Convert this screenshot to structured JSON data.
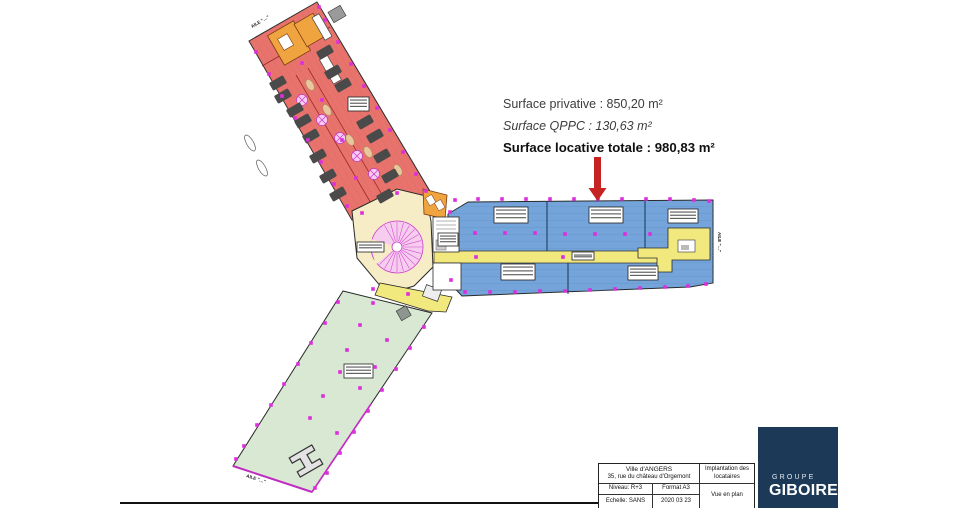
{
  "annotation": {
    "surface_privative": "Surface privative : 850,20 m²",
    "surface_qppc": "Surface QPPC : 130,63 m²",
    "surface_locative_totale": "Surface locative totale : 980,83 m²"
  },
  "plan": {
    "wing_labels": {
      "top": "AILE \"…\"",
      "right": "AILE \"…\"",
      "bottom": "AILE \"…\""
    },
    "colors": {
      "red_wing": "#E8736D",
      "blue_wing": "#74A4DA",
      "green_wing": "#D8E8D2",
      "center": "#F6ECC5",
      "corridor": "#F2E97E",
      "orange_room": "#F0A440",
      "marker": "#DD2EDD",
      "furniture": "#4A4A4A",
      "arrow": "#C62222"
    },
    "column_markers": [
      [
        455,
        200
      ],
      [
        478,
        199
      ],
      [
        502,
        199
      ],
      [
        526,
        199
      ],
      [
        550,
        199
      ],
      [
        574,
        199
      ],
      [
        598,
        199
      ],
      [
        622,
        199
      ],
      [
        646,
        199
      ],
      [
        670,
        199
      ],
      [
        694,
        200
      ],
      [
        709,
        201
      ],
      [
        475,
        233
      ],
      [
        505,
        233
      ],
      [
        535,
        233
      ],
      [
        565,
        234
      ],
      [
        595,
        234
      ],
      [
        625,
        234
      ],
      [
        650,
        234
      ],
      [
        465,
        292
      ],
      [
        490,
        292
      ],
      [
        515,
        292
      ],
      [
        540,
        291
      ],
      [
        565,
        291
      ],
      [
        590,
        290
      ],
      [
        615,
        289
      ],
      [
        640,
        288
      ],
      [
        665,
        287
      ],
      [
        688,
        286
      ],
      [
        706,
        284
      ],
      [
        476,
        257
      ],
      [
        563,
        257
      ],
      [
        450,
        212
      ],
      [
        451,
        280
      ],
      [
        319,
        7
      ],
      [
        325,
        20
      ],
      [
        338,
        42
      ],
      [
        351,
        64
      ],
      [
        364,
        86
      ],
      [
        377,
        108
      ],
      [
        390,
        130
      ],
      [
        403,
        152
      ],
      [
        416,
        174
      ],
      [
        426,
        191
      ],
      [
        256,
        52
      ],
      [
        269,
        74
      ],
      [
        282,
        96
      ],
      [
        295,
        118
      ],
      [
        308,
        140
      ],
      [
        321,
        162
      ],
      [
        334,
        184
      ],
      [
        347,
        206
      ],
      [
        302,
        63
      ],
      [
        322,
        100
      ],
      [
        342,
        140
      ],
      [
        356,
        178
      ],
      [
        338,
        302
      ],
      [
        325,
        323
      ],
      [
        311,
        343
      ],
      [
        298,
        364
      ],
      [
        284,
        384
      ],
      [
        271,
        405
      ],
      [
        257,
        425
      ],
      [
        244,
        446
      ],
      [
        236,
        459
      ],
      [
        424,
        327
      ],
      [
        410,
        348
      ],
      [
        396,
        369
      ],
      [
        382,
        390
      ],
      [
        368,
        411
      ],
      [
        354,
        432
      ],
      [
        340,
        453
      ],
      [
        327,
        473
      ],
      [
        315,
        488
      ],
      [
        373,
        303
      ],
      [
        360,
        325
      ],
      [
        387,
        340
      ],
      [
        347,
        350
      ],
      [
        375,
        367
      ],
      [
        340,
        372
      ],
      [
        360,
        388
      ],
      [
        323,
        396
      ],
      [
        310,
        418
      ],
      [
        337,
        433
      ],
      [
        362,
        213
      ],
      [
        397,
        193
      ],
      [
        373,
        289
      ],
      [
        408,
        294
      ]
    ],
    "furniture_clusters": [
      [
        325,
        52
      ],
      [
        333,
        72
      ],
      [
        278,
        83
      ],
      [
        283,
        96
      ],
      [
        343,
        85
      ],
      [
        295,
        110
      ],
      [
        303,
        121
      ],
      [
        311,
        136
      ],
      [
        318,
        156
      ],
      [
        328,
        176
      ],
      [
        338,
        194
      ],
      [
        365,
        122
      ],
      [
        375,
        136
      ],
      [
        382,
        156
      ],
      [
        390,
        176
      ],
      [
        385,
        196
      ]
    ],
    "micro_labels": [
      {
        "x": 348,
        "y": 97,
        "w": 21,
        "h": 14
      },
      {
        "x": 357,
        "y": 242,
        "w": 27,
        "h": 10
      },
      {
        "x": 438,
        "y": 233,
        "w": 20,
        "h": 13
      },
      {
        "x": 494,
        "y": 207,
        "w": 34,
        "h": 16
      },
      {
        "x": 589,
        "y": 207,
        "w": 34,
        "h": 16
      },
      {
        "x": 668,
        "y": 209,
        "w": 30,
        "h": 14
      },
      {
        "x": 501,
        "y": 264,
        "w": 34,
        "h": 16
      },
      {
        "x": 628,
        "y": 266,
        "w": 30,
        "h": 14
      },
      {
        "x": 572,
        "y": 252,
        "w": 22,
        "h": 8
      },
      {
        "x": 344,
        "y": 364,
        "w": 29,
        "h": 14
      }
    ]
  },
  "title_block": {
    "project": "Ville d'ANGERS",
    "address": "35, rue du château d'Orgemont",
    "doc_type": "Implantation des locataires",
    "level": "Niveau: R+3",
    "format": "Format A3",
    "view": "Vue en plan",
    "scale": "Echelle: SANS",
    "date": "2020 03 23"
  },
  "logo": {
    "group": "GROUPE",
    "name": "GIBOIRE"
  }
}
